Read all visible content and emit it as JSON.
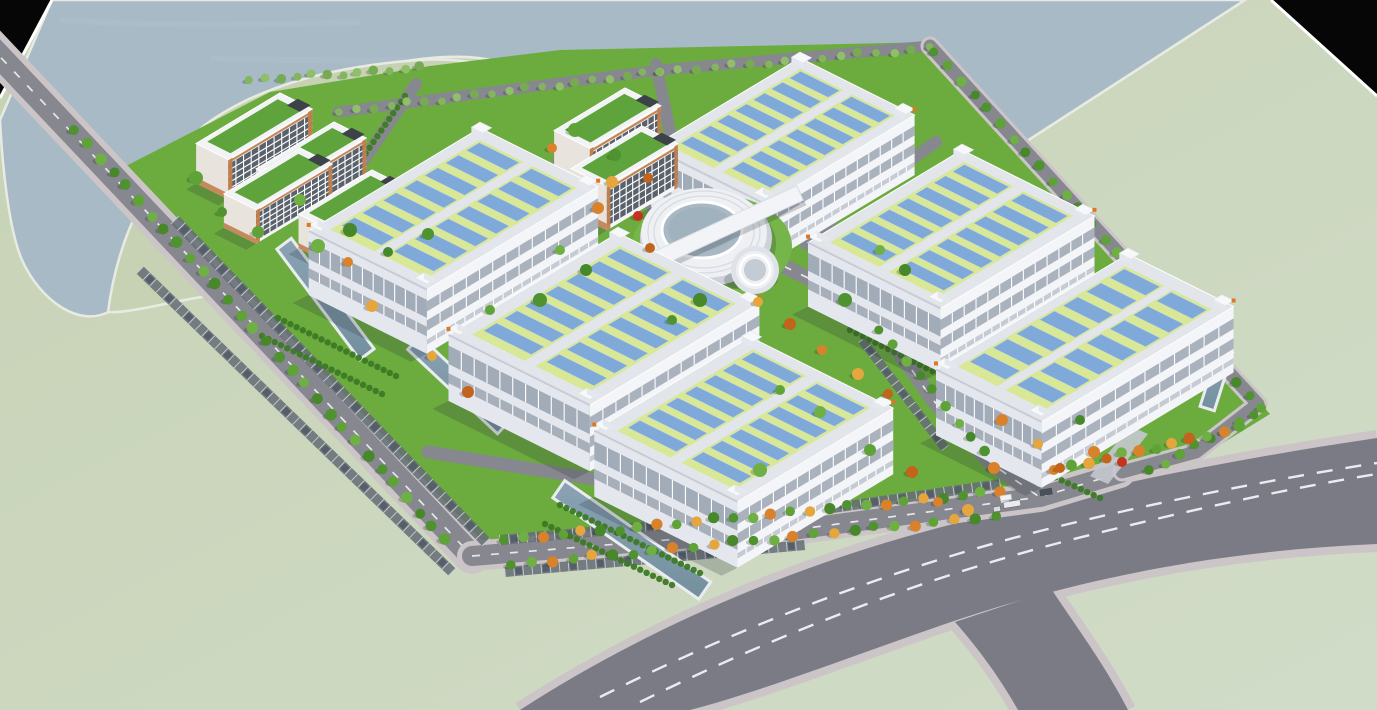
{
  "scene": {
    "canvas": {
      "w": 1377,
      "h": 710
    },
    "colors": {
      "land1": "#c7d2b5",
      "land2": "#d1dcc8",
      "water": "#a7bac6",
      "shore": "#e7ebe2",
      "black": "#060606",
      "campus": "#6cac3e",
      "lawnBright": "#76b549",
      "roadPublic": "#7b7b85",
      "roadCampus": "#87878f",
      "sidewalk": "#cbc5c7",
      "dash": "#f0f2f5",
      "wallLight": "#f4f5f8",
      "wallShade": "#e4e7ee",
      "winBand": "#97a1ae",
      "roofBorder": "#e2e5ea",
      "roofShade": "#c7ccd6",
      "roofGreen": "#d9e896",
      "panel": "#7ea9d8",
      "panelLine": "#b9d0ea",
      "towerOrange": "#e0761f",
      "dormWall": "#f6f6f6",
      "dormShade": "#e8e3dc",
      "dormOrange": "#c27e4e",
      "dormWin": "#59616b",
      "dormRoof": "#5ea33b",
      "ringWhite": "#eef0f4",
      "ringShade": "#cdd2da",
      "courtyard": "#a9b9c4",
      "channel": "#8aa2b4",
      "channelDeep": "#74909e",
      "channelRim": "#e9edf0",
      "hedge": "#3c7a24",
      "parking": "#656c76",
      "stallLine": "#c6ccd3",
      "shadow": "rgba(35,45,55,0.22)"
    },
    "axes": {
      "u": [
        0.895,
        0.445
      ],
      "v": [
        -0.865,
        0.52
      ]
    },
    "water_path": "M52,0 L1245,0 L908,218 C858,204 812,158 784,110 C768,82 748,62 718,56 C688,52 664,62 648,86 C636,103 622,113 605,116 C586,119 568,110 552,93 C534,73 504,59 468,57 C415,55 345,70 292,96 C238,122 188,166 158,212 C136,247 120,282 112,310 C80,330 40,300 22,260 C8,228 2,160 0,120 Z",
    "shoreline": [
      [
        908,
        218
      ],
      [
        1245,
        0
      ]
    ],
    "peninsula_path": "M108,312 C118,235 150,170 205,125 C255,88 330,66 420,60 C470,57 510,68 535,92 C552,108 570,120 595,118 C620,116 640,122 668,148 C700,178 728,215 740,252 C744,268 738,278 720,280 C660,285 560,282 470,278 C360,272 230,290 160,305 C140,309 120,313 108,312 Z",
    "corner_tl": {
      "pts": [
        [
          0,
          0
        ],
        [
          52,
          0
        ],
        [
          0,
          98
        ]
      ],
      "edge": [
        [
          52,
          0
        ],
        [
          0,
          98
        ]
      ]
    },
    "corner_tr": {
      "pts": [
        [
          1271,
          0
        ],
        [
          1377,
          0
        ],
        [
          1377,
          96
        ]
      ],
      "edge": [
        [
          1271,
          0
        ],
        [
          1377,
          96
        ]
      ]
    },
    "campus_pts": [
      [
        95,
        182
      ],
      [
        270,
        92
      ],
      [
        430,
        66
      ],
      [
        560,
        50
      ],
      [
        935,
        42
      ],
      [
        1270,
        414
      ],
      [
        1192,
        462
      ],
      [
        1120,
        472
      ],
      [
        1040,
        498
      ],
      [
        800,
        530
      ],
      [
        472,
        558
      ]
    ],
    "public_road": {
      "fill_path": "M520,710 C620,645 750,582 905,537 C1060,494 1215,462 1377,438 L1377,544 C1230,550 1085,576 945,624 C855,655 760,692 690,710 Z",
      "edge_paths": [
        "M520,710 C620,645 750,582 905,537 C1060,494 1215,462 1377,438",
        "M1377,544 C1230,550 1085,576 945,624 C855,655 760,692 690,710"
      ],
      "branch_path": "M955,622 L1052,590 C1075,625 1105,665 1128,710 L1018,710 C1000,678 978,648 955,622 Z",
      "branch_edges": [
        "M1052,590 C1075,625 1105,665 1128,710",
        "M955,622 C978,648 1000,678 1018,710"
      ],
      "dashes": [
        "M600,697 C730,632 880,572 1040,531 C1160,501 1280,478 1377,463",
        "M640,702 C770,638 915,580 1070,540 C1185,511 1290,488 1377,474"
      ]
    },
    "roads": [
      {
        "name": "west-perimeter-road",
        "pts": [
          [
            -12,
            44
          ],
          [
            472,
            556
          ]
        ],
        "w": 24,
        "sw": 36,
        "dash": true
      },
      {
        "name": "south-perimeter-road",
        "pts": [
          [
            472,
            556
          ],
          [
            800,
            529
          ],
          [
            1040,
            497
          ],
          [
            1120,
            473
          ]
        ],
        "w": 20,
        "sw": 30,
        "dash": true
      },
      {
        "name": "north-edge-road",
        "pts": [
          [
            338,
            112
          ],
          [
            660,
            70
          ],
          [
            930,
            46
          ]
        ],
        "w": 11,
        "sw": 0,
        "dash": false
      },
      {
        "name": "east-perimeter-road",
        "pts": [
          [
            930,
            46
          ],
          [
            1105,
            238
          ],
          [
            1258,
            404
          ],
          [
            1196,
            452
          ],
          [
            1122,
            472
          ]
        ],
        "w": 13,
        "sw": 19,
        "dash": false
      },
      {
        "name": "internal-road-nw",
        "pts": [
          [
            416,
            84
          ],
          [
            346,
            186
          ],
          [
            330,
            252
          ]
        ],
        "w": 12,
        "sw": 0,
        "dash": false
      },
      {
        "name": "internal-road-center",
        "pts": [
          [
            560,
            162
          ],
          [
            600,
            180
          ],
          [
            742,
            246
          ],
          [
            866,
            306
          ]
        ],
        "w": 15,
        "sw": 0,
        "dash": true
      },
      {
        "name": "internal-road-north",
        "pts": [
          [
            656,
            64
          ],
          [
            672,
            142
          ],
          [
            702,
            210
          ]
        ],
        "w": 12,
        "sw": 0,
        "dash": false
      },
      {
        "name": "internal-road-bd",
        "pts": [
          [
            936,
            142
          ],
          [
            846,
            206
          ],
          [
            806,
            244
          ]
        ],
        "w": 12,
        "sw": 0,
        "dash": false
      },
      {
        "name": "internal-road-ef",
        "pts": [
          [
            868,
            308
          ],
          [
            933,
            400
          ],
          [
            992,
            464
          ],
          [
            1038,
            496
          ]
        ],
        "w": 15,
        "sw": 0,
        "dash": true
      },
      {
        "name": "internal-road-ce",
        "pts": [
          [
            428,
            452
          ],
          [
            612,
            482
          ],
          [
            792,
            527
          ]
        ],
        "w": 13,
        "sw": 0,
        "dash": false
      }
    ],
    "parking_rows": [
      {
        "from": [
          175,
          220
        ],
        "to": [
          486,
          542
        ],
        "w": 11
      },
      {
        "from": [
          140,
          270
        ],
        "to": [
          452,
          572
        ],
        "w": 10
      },
      {
        "from": [
          500,
          540
        ],
        "to": [
          800,
          513
        ],
        "w": 10
      },
      {
        "from": [
          805,
          512
        ],
        "to": [
          1000,
          484
        ],
        "w": 10
      },
      {
        "from": [
          505,
          572
        ],
        "to": [
          805,
          545
        ],
        "w": 10
      },
      {
        "from": [
          862,
          340
        ],
        "to": [
          945,
          448
        ],
        "w": 9
      }
    ],
    "channels": [
      {
        "p": [
          285,
          245
        ],
        "dir": [
          0.6,
          0.8
        ],
        "len": 135,
        "w": 15
      },
      {
        "p": [
          415,
          344
        ],
        "dir": [
          0.73,
          0.685
        ],
        "len": 120,
        "w": 15
      },
      {
        "p": [
          560,
          490
        ],
        "dir": [
          0.82,
          0.57
        ],
        "len": 175,
        "w": 18
      },
      {
        "p": [
          1225,
          352
        ],
        "dir": [
          -0.3,
          0.95
        ],
        "len": 58,
        "w": 12
      }
    ],
    "aprons": [
      [
        [
          500,
          300
        ],
        [
          516,
          308
        ],
        [
          470,
          352
        ],
        [
          454,
          344
        ]
      ],
      [
        [
          664,
          412
        ],
        [
          682,
          421
        ],
        [
          640,
          470
        ],
        [
          622,
          461
        ]
      ],
      [
        [
          812,
          455
        ],
        [
          830,
          464
        ],
        [
          790,
          515
        ],
        [
          772,
          506
        ]
      ],
      [
        [
          1009,
          324
        ],
        [
          1027,
          332
        ],
        [
          988,
          380
        ],
        [
          970,
          372
        ]
      ],
      [
        [
          1130,
          426
        ],
        [
          1148,
          434
        ],
        [
          1108,
          484
        ],
        [
          1090,
          476
        ]
      ]
    ],
    "factories": [
      {
        "id": "factory-B",
        "n": [
          800,
          58
        ],
        "a": 128,
        "b": 172,
        "h": 60
      },
      {
        "id": "factory-A",
        "n": [
          480,
          128
        ],
        "a": 132,
        "b": 198,
        "h": 64
      },
      {
        "id": "factory-D",
        "n": [
          962,
          150
        ],
        "a": 148,
        "b": 178,
        "h": 64
      },
      {
        "id": "factory-C",
        "n": [
          618,
          233
        ],
        "a": 158,
        "b": 196,
        "h": 66
      },
      {
        "id": "factory-F",
        "n": [
          1128,
          254
        ],
        "a": 118,
        "b": 222,
        "h": 66
      },
      {
        "id": "factory-E",
        "n": [
          750,
          337
        ],
        "a": 160,
        "b": 180,
        "h": 66
      }
    ],
    "dorms": [
      {
        "id": "dorm-1",
        "n": [
          280,
          93
        ],
        "a": 36,
        "b": 97,
        "h": 40
      },
      {
        "id": "dorm-2",
        "n": [
          334,
          122
        ],
        "a": 36,
        "b": 90,
        "h": 38
      },
      {
        "id": "dorm-3",
        "n": [
          300,
          148
        ],
        "a": 36,
        "b": 88,
        "h": 34
      },
      {
        "id": "dorm-4",
        "n": [
          372,
          170
        ],
        "a": 36,
        "b": 85,
        "h": 34
      },
      {
        "id": "dorm-5",
        "n": [
          625,
          88
        ],
        "a": 40,
        "b": 82,
        "h": 44
      },
      {
        "id": "dorm-6",
        "n": [
          642,
          126
        ],
        "a": 40,
        "b": 82,
        "h": 44
      }
    ],
    "round_building": {
      "lawn": [
        712,
        246,
        80,
        52
      ],
      "terrace": [
        706,
        238,
        66,
        48
      ],
      "ring": [
        704,
        233,
        63,
        45
      ],
      "floor_rings": [
        [
          704,
          232,
          50,
          36
        ],
        [
          704,
          232,
          56,
          41
        ]
      ],
      "courtyard": [
        702,
        230,
        40,
        28
      ],
      "courtyard_inner": [
        701,
        229,
        33,
        22
      ],
      "bar": {
        "a": [
          646,
          264
        ],
        "b": [
          800,
          193
        ],
        "w": 16
      },
      "cylinder": {
        "c": [
          755,
          270
        ],
        "r": 24
      }
    },
    "tree_rows_back": [
      {
        "from": [
          75,
          130
        ],
        "to": [
          445,
          540
        ],
        "n": 30,
        "r": 5,
        "pal": "green"
      },
      {
        "from": [
          250,
          80
        ],
        "to": [
          420,
          68
        ],
        "n": 12,
        "r": 4,
        "pal": "poplar"
      },
      {
        "from": [
          340,
          112
        ],
        "to": [
          660,
          72
        ],
        "n": 20,
        "r": 3.8,
        "pal": "poplar"
      },
      {
        "from": [
          660,
          72
        ],
        "to": [
          930,
          48
        ],
        "n": 16,
        "r": 3.8,
        "pal": "poplar"
      },
      {
        "from": [
          935,
          52
        ],
        "to": [
          1262,
          410
        ],
        "n": 26,
        "r": 4.5,
        "pal": "green"
      },
      {
        "from": [
          1255,
          415
        ],
        "to": [
          1150,
          470
        ],
        "n": 8,
        "r": 4.5,
        "pal": "green"
      }
    ],
    "tree_rows_front": [
      {
        "from": [
          505,
          540
        ],
        "to": [
          1000,
          492
        ],
        "n": 27,
        "r": 4.8,
        "pal": "mixed"
      },
      {
        "from": [
          512,
          565
        ],
        "to": [
          995,
          516
        ],
        "n": 25,
        "r": 4.8,
        "pal": "mixed"
      },
      {
        "from": [
          1055,
          470
        ],
        "to": [
          1240,
          428
        ],
        "n": 12,
        "r": 5,
        "pal": "autumnmix"
      },
      {
        "from": [
          880,
          330
        ],
        "to": [
          985,
          452
        ],
        "n": 9,
        "r": 4.5,
        "pal": "green"
      }
    ],
    "hedges": [
      {
        "from": [
          278,
          318
        ],
        "to": [
          396,
          376
        ]
      },
      {
        "from": [
          262,
          336
        ],
        "to": [
          382,
          394
        ]
      },
      {
        "from": [
          452,
          352
        ],
        "to": [
          566,
          408
        ]
      },
      {
        "from": [
          560,
          505
        ],
        "to": [
          700,
          573
        ]
      },
      {
        "from": [
          545,
          524
        ],
        "to": [
          672,
          585
        ]
      },
      {
        "from": [
          850,
          330
        ],
        "to": [
          958,
          384
        ]
      },
      {
        "from": [
          985,
          445
        ],
        "to": [
          1100,
          498
        ]
      },
      {
        "from": [
          405,
          96
        ],
        "to": [
          342,
          188
        ]
      },
      {
        "from": [
          740,
          430
        ],
        "to": [
          830,
          474
        ]
      }
    ],
    "green_trees": [
      [
        222,
        212
      ],
      [
        258,
        232
      ],
      [
        318,
        246
      ],
      [
        388,
        252
      ],
      [
        428,
        234
      ],
      [
        196,
        178
      ],
      [
        560,
        250
      ],
      [
        586,
        270
      ],
      [
        540,
        300
      ],
      [
        780,
        390
      ],
      [
        820,
        412
      ],
      [
        700,
        300
      ],
      [
        672,
        320
      ],
      [
        870,
        450
      ],
      [
        760,
        470
      ],
      [
        1080,
        420
      ],
      [
        615,
        155
      ],
      [
        575,
        130
      ],
      [
        880,
        250
      ],
      [
        905,
        270
      ],
      [
        845,
        300
      ],
      [
        490,
        310
      ],
      [
        300,
        200
      ],
      [
        350,
        230
      ]
    ],
    "autumn_trees": [
      [
        552,
        148
      ],
      [
        612,
        182
      ],
      [
        648,
        178
      ],
      [
        598,
        208
      ],
      [
        758,
        302
      ],
      [
        790,
        324
      ],
      [
        822,
        350
      ],
      [
        858,
        374
      ],
      [
        888,
        394
      ],
      [
        1002,
        420
      ],
      [
        1038,
        444
      ],
      [
        912,
        472
      ],
      [
        938,
        502
      ],
      [
        968,
        510
      ],
      [
        1060,
        468
      ],
      [
        1094,
        452
      ],
      [
        432,
        356
      ],
      [
        468,
        392
      ],
      [
        348,
        262
      ],
      [
        372,
        306
      ],
      [
        650,
        248
      ],
      [
        994,
        468
      ]
    ],
    "red_trees": [
      [
        638,
        216
      ],
      [
        1122,
        462
      ]
    ],
    "vehicles": [
      {
        "x": 1012,
        "y": 504,
        "w": 17,
        "h": 6,
        "rot": -9,
        "c": "#e9ebee"
      },
      {
        "x": 1046,
        "y": 492,
        "w": 12,
        "h": 6,
        "rot": -9,
        "c": "#49525c"
      },
      {
        "x": 997,
        "y": 509,
        "w": 7,
        "h": 5,
        "rot": -9,
        "c": "#d9dde2"
      }
    ],
    "gate": {
      "x": 1000,
      "y": 496,
      "w": 11,
      "h": 5
    }
  }
}
